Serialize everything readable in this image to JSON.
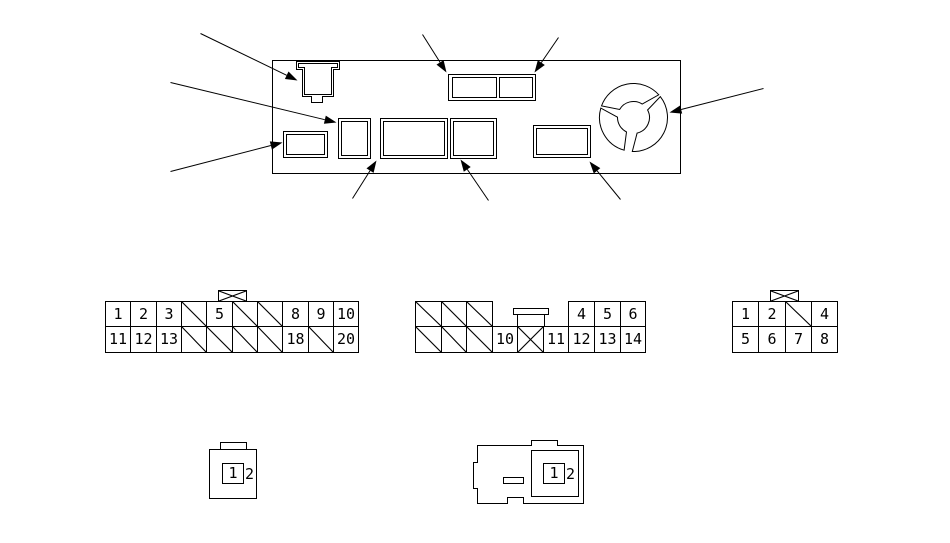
{
  "colors": {
    "line": "#000000",
    "background": "#ffffff"
  },
  "connectors": {
    "connector_a_20pin": {
      "key_symbol": "crossed-box-key-symbol",
      "rows": [
        [
          "1",
          "2",
          "3",
          "slash",
          "5",
          "slash",
          "slash",
          "8",
          "9",
          "10"
        ],
        [
          "11",
          "12",
          "13",
          "slash",
          "slash",
          "slash",
          "slash",
          "18",
          "slash",
          "20"
        ]
      ]
    },
    "connector_b_14pin": {
      "key_symbol": "tab-key-symbol",
      "rows": [
        [
          "slash",
          "slash",
          "slash",
          "",
          "",
          "",
          "4",
          "5",
          "6"
        ],
        [
          "slash",
          "slash",
          "slash",
          "10",
          "cross",
          "11",
          "12",
          "13",
          "14"
        ]
      ]
    },
    "connector_c_8pin": {
      "key_symbol": "crossed-box-key-symbol",
      "rows": [
        [
          "1",
          "2",
          "slash",
          "4"
        ],
        [
          "5",
          "6",
          "7",
          "8"
        ]
      ]
    },
    "connector_d_2pin": {
      "pins": [
        "1",
        "2"
      ]
    },
    "connector_e_2pin": {
      "pins": [
        "1",
        "2"
      ]
    }
  }
}
